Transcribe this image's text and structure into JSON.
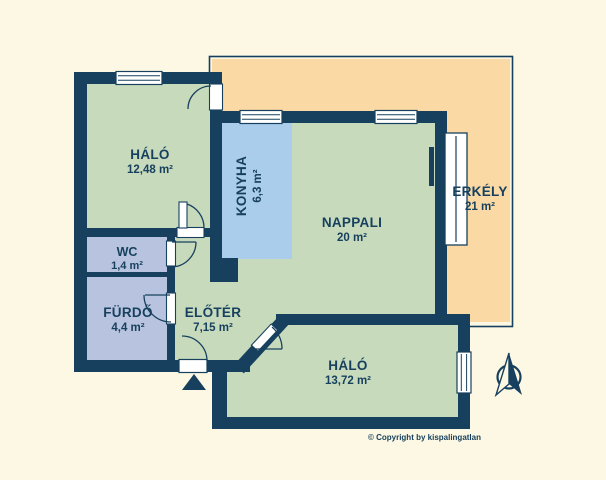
{
  "title": "Apartment floor plan",
  "copyright": "© Copyright by kispalingatlan",
  "colors": {
    "background": "#fcf8e3",
    "walls": "#17405e",
    "room_green": "#c7dbbc",
    "kitchen_blue": "#a9cdea",
    "bath_lavender": "#b8c4df",
    "balcony_orange": "#fad9a4",
    "window_white": "#ffffff"
  },
  "rooms": [
    {
      "id": "halo1",
      "name": "HÁLÓ",
      "area": "12,48 m²"
    },
    {
      "id": "konyha",
      "name": "KONYHA",
      "area": "6,3 m²"
    },
    {
      "id": "nappali",
      "name": "NAPPALI",
      "area": "20 m²"
    },
    {
      "id": "erkely",
      "name": "ERKÉLY",
      "area": "21 m²"
    },
    {
      "id": "wc",
      "name": "WC",
      "area": "1,4 m²"
    },
    {
      "id": "furdo",
      "name": "FÜRDŐ",
      "area": "4,4 m²"
    },
    {
      "id": "eloter",
      "name": "ELŐTÉR",
      "area": "7,15 m²"
    },
    {
      "id": "halo2",
      "name": "HÁLÓ",
      "area": "13,72 m²"
    }
  ]
}
